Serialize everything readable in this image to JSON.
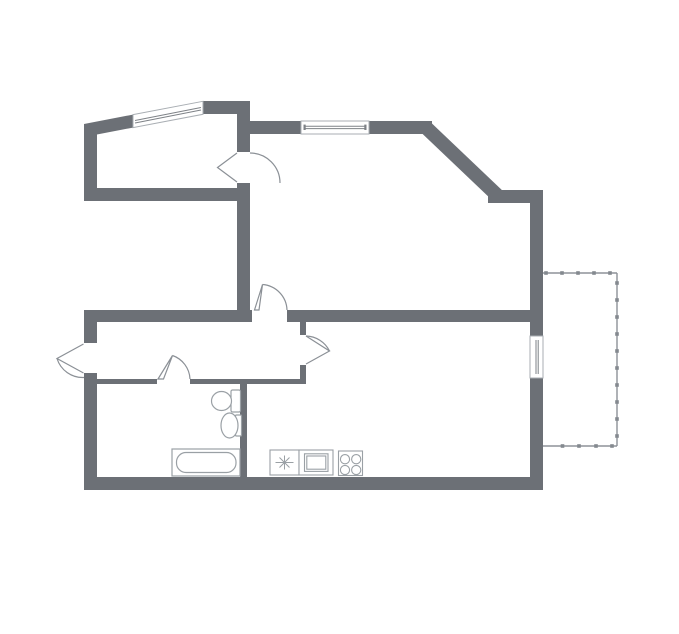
{
  "floorplan": {
    "canvas": {
      "w": 679,
      "h": 634,
      "bg": "#ffffff"
    },
    "colors": {
      "wall": "#6c7076",
      "fixture": "#9aa0a5",
      "railing": "#8d9298",
      "glaze": "#7e8287"
    },
    "groups": [
      {
        "name": "walls",
        "defaults": {
          "fill": "#6c7076",
          "stroke": "none",
          "sw": 0
        },
        "shapes": [
          {
            "name": "wall-room1-left",
            "kind": "rect",
            "x": 84,
            "y": 124,
            "w": 13,
            "h": 77
          },
          {
            "name": "wall-room1-slant",
            "kind": "poly",
            "points": "84,124 133,114.6 133,127.6 84,137"
          },
          {
            "name": "wall-room1-top",
            "kind": "rect",
            "x": 203,
            "y": 101,
            "w": 47,
            "h": 13
          },
          {
            "name": "wall-room1-right-upper",
            "kind": "rect",
            "x": 237,
            "y": 101,
            "w": 13,
            "h": 51
          },
          {
            "name": "wall-room1-right-lower",
            "kind": "rect",
            "x": 237,
            "y": 183,
            "w": 13,
            "h": 139
          },
          {
            "name": "wall-room1-bottom",
            "kind": "rect",
            "x": 84,
            "y": 188,
            "w": 166,
            "h": 13
          },
          {
            "name": "wall-living-top-left",
            "kind": "rect",
            "x": 250,
            "y": 121,
            "w": 51,
            "h": 13
          },
          {
            "name": "wall-living-top-right",
            "kind": "rect",
            "x": 369,
            "y": 121,
            "w": 63,
            "h": 13
          },
          {
            "name": "wall-diagonal",
            "kind": "line",
            "x1": 426,
            "y1": 127.5,
            "x2": 499,
            "y2": 197,
            "stroke": "#6c7076",
            "sw": 14
          },
          {
            "name": "wall-topright-horizontal",
            "kind": "rect",
            "x": 488,
            "y": 190,
            "w": 55,
            "h": 13
          },
          {
            "name": "wall-right-upper",
            "kind": "rect",
            "x": 530,
            "y": 190,
            "w": 13,
            "h": 146
          },
          {
            "name": "wall-right-lower",
            "kind": "rect",
            "x": 530,
            "y": 378,
            "w": 13,
            "h": 112
          },
          {
            "name": "wall-bottom",
            "kind": "rect",
            "x": 84,
            "y": 477,
            "w": 459,
            "h": 13
          },
          {
            "name": "wall-left-lower-above-door",
            "kind": "rect",
            "x": 84,
            "y": 310,
            "w": 13,
            "h": 33
          },
          {
            "name": "wall-left-lower-below-door",
            "kind": "rect",
            "x": 84,
            "y": 373,
            "w": 13,
            "h": 117
          },
          {
            "name": "wall-hall-top-left",
            "kind": "rect",
            "x": 84,
            "y": 310,
            "w": 168,
            "h": 12
          },
          {
            "name": "wall-hall-top-right",
            "kind": "rect",
            "x": 287,
            "y": 310,
            "w": 256,
            "h": 12
          },
          {
            "name": "wall-bath-top-left",
            "kind": "rect",
            "x": 96,
            "y": 379,
            "w": 61,
            "h": 5
          },
          {
            "name": "wall-bath-top-right",
            "kind": "rect",
            "x": 190,
            "y": 379,
            "w": 116,
            "h": 5
          },
          {
            "name": "wall-bath-right",
            "kind": "rect",
            "x": 240,
            "y": 384,
            "w": 7,
            "h": 93
          },
          {
            "name": "wall-kitchen-door-stub-upper",
            "kind": "rect",
            "x": 300,
            "y": 322,
            "w": 6,
            "h": 13
          },
          {
            "name": "wall-kitchen-door-stub-lower",
            "kind": "rect",
            "x": 300,
            "y": 365,
            "w": 6,
            "h": 14
          }
        ]
      },
      {
        "name": "windows",
        "defaults": {
          "stroke": "#a9aeb3",
          "fill": "#ffffff",
          "sw": 1
        },
        "shapes": [
          {
            "name": "window-room1-slanted",
            "kind": "poly",
            "points": "133,114.6 203,101.3 203,114.3 133,127.6"
          },
          {
            "name": "window-room1-glaze-line-1",
            "kind": "line",
            "x1": 135,
            "y1": 120.5,
            "x2": 201,
            "y2": 107.5,
            "stroke": "#7e8287"
          },
          {
            "name": "window-room1-glaze-line-2",
            "kind": "line",
            "x1": 135,
            "y1": 123,
            "x2": 201,
            "y2": 110,
            "stroke": "#7e8287"
          },
          {
            "name": "window-living-top",
            "kind": "rect",
            "x": 301,
            "y": 121,
            "w": 68,
            "h": 13
          },
          {
            "name": "window-living-glaze-line-1",
            "kind": "line",
            "x1": 304,
            "y1": 126.3,
            "x2": 366,
            "y2": 126.3,
            "stroke": "#7e8287"
          },
          {
            "name": "window-living-glaze-line-2",
            "kind": "line",
            "x1": 304,
            "y1": 128.6,
            "x2": 366,
            "y2": 128.6,
            "stroke": "#7e8287"
          },
          {
            "name": "window-living-tick-left",
            "kind": "rect",
            "x": 303.5,
            "y": 124.6,
            "w": 2.2,
            "h": 5.4,
            "fill": "#7e8287",
            "stroke": "none"
          },
          {
            "name": "window-living-tick-right",
            "kind": "rect",
            "x": 364.3,
            "y": 124.6,
            "w": 2.2,
            "h": 5.4,
            "fill": "#7e8287",
            "stroke": "none"
          },
          {
            "name": "window-balcony",
            "kind": "rect",
            "x": 530,
            "y": 336,
            "w": 13,
            "h": 42
          },
          {
            "name": "window-balcony-glaze-line-1",
            "kind": "line",
            "x1": 536,
            "y1": 340,
            "x2": 536,
            "y2": 374,
            "stroke": "#7e8287"
          },
          {
            "name": "window-balcony-glaze-line-2",
            "kind": "line",
            "x1": 538.2,
            "y1": 340,
            "x2": 538.2,
            "y2": 374,
            "stroke": "#7e8287"
          }
        ]
      },
      {
        "name": "doors",
        "defaults": {
          "stroke": "#8b9096",
          "fill": "none",
          "sw": 1.2
        },
        "shapes": [
          {
            "name": "door-room1-leaf",
            "kind": "path",
            "d": "M 237 153 L 217.5 167.5 L 237 182",
            "fill": "#ffffff"
          },
          {
            "name": "door-room1-swing-arc",
            "kind": "path",
            "d": "M 250 153 A 30 30 0 0 1 280 183"
          },
          {
            "name": "door-living-hall-leaf",
            "kind": "path",
            "d": "M 254.5 310 L 262.5 284.5 L 259 310 Z",
            "fill": "#ffffff"
          },
          {
            "name": "door-living-hall-swing-arc",
            "kind": "path",
            "d": "M 262.5 284.5 A 26.5 26.5 0 0 1 287 310"
          },
          {
            "name": "door-entrance-leaf",
            "kind": "path",
            "d": "M 83.5 344 L 57 358.5 L 83.5 373",
            "fill": "#ffffff"
          },
          {
            "name": "door-entrance-swing-arc",
            "kind": "path",
            "d": "M 57 358.5 A 27 27 0 0 0 84 377.5"
          },
          {
            "name": "door-bathroom-leaf",
            "kind": "path",
            "d": "M 158 379 L 172.5 355.5 L 163.5 379 Z",
            "fill": "#ffffff"
          },
          {
            "name": "door-bathroom-swing-arc",
            "kind": "path",
            "d": "M 172.5 355.5 A 26 26 0 0 1 190 379"
          },
          {
            "name": "door-kitchen-leaf",
            "kind": "path",
            "d": "M 306 336 L 329.5 351 L 306 364",
            "fill": "#ffffff"
          },
          {
            "name": "door-kitchen-swing-arc",
            "kind": "path",
            "d": "M 306 336 A 27 27 0 0 1 329.5 351"
          }
        ]
      },
      {
        "name": "balcony-railing",
        "defaults": {
          "stroke": "#8d9298",
          "fill": "none",
          "sw": 1.4
        },
        "shapes": [
          {
            "name": "balcony-rail-top",
            "kind": "line",
            "x1": 543,
            "y1": 273,
            "x2": 617,
            "y2": 273
          },
          {
            "name": "balcony-rail-right",
            "kind": "line",
            "x1": 617,
            "y1": 273,
            "x2": 617,
            "y2": 446
          },
          {
            "name": "balcony-rail-bottom",
            "kind": "line",
            "x1": 543,
            "y1": 446,
            "x2": 617,
            "y2": 446
          },
          {
            "name": "balcony-post",
            "kind": "rect",
            "x": 544.2,
            "y": 271.2,
            "w": 3.6,
            "h": 3.6,
            "fill": "#84898f",
            "stroke": "none"
          },
          {
            "name": "balcony-post",
            "kind": "rect",
            "x": 560.2,
            "y": 271.2,
            "w": 3.6,
            "h": 3.6,
            "fill": "#84898f",
            "stroke": "none"
          },
          {
            "name": "balcony-post",
            "kind": "rect",
            "x": 576.2,
            "y": 271.2,
            "w": 3.6,
            "h": 3.6,
            "fill": "#84898f",
            "stroke": "none"
          },
          {
            "name": "balcony-post",
            "kind": "rect",
            "x": 592.2,
            "y": 271.2,
            "w": 3.6,
            "h": 3.6,
            "fill": "#84898f",
            "stroke": "none"
          },
          {
            "name": "balcony-post",
            "kind": "rect",
            "x": 608.2,
            "y": 271.2,
            "w": 3.6,
            "h": 3.6,
            "fill": "#84898f",
            "stroke": "none"
          },
          {
            "name": "balcony-post",
            "kind": "rect",
            "x": 615.2,
            "y": 281.2,
            "w": 3.6,
            "h": 3.6,
            "fill": "#84898f",
            "stroke": "none"
          },
          {
            "name": "balcony-post",
            "kind": "rect",
            "x": 615.2,
            "y": 298.2,
            "w": 3.6,
            "h": 3.6,
            "fill": "#84898f",
            "stroke": "none"
          },
          {
            "name": "balcony-post",
            "kind": "rect",
            "x": 615.2,
            "y": 315.2,
            "w": 3.6,
            "h": 3.6,
            "fill": "#84898f",
            "stroke": "none"
          },
          {
            "name": "balcony-post",
            "kind": "rect",
            "x": 615.2,
            "y": 332.2,
            "w": 3.6,
            "h": 3.6,
            "fill": "#84898f",
            "stroke": "none"
          },
          {
            "name": "balcony-post",
            "kind": "rect",
            "x": 615.2,
            "y": 349.2,
            "w": 3.6,
            "h": 3.6,
            "fill": "#84898f",
            "stroke": "none"
          },
          {
            "name": "balcony-post",
            "kind": "rect",
            "x": 615.2,
            "y": 366.2,
            "w": 3.6,
            "h": 3.6,
            "fill": "#84898f",
            "stroke": "none"
          },
          {
            "name": "balcony-post",
            "kind": "rect",
            "x": 615.2,
            "y": 383.2,
            "w": 3.6,
            "h": 3.6,
            "fill": "#84898f",
            "stroke": "none"
          },
          {
            "name": "balcony-post",
            "kind": "rect",
            "x": 615.2,
            "y": 400.2,
            "w": 3.6,
            "h": 3.6,
            "fill": "#84898f",
            "stroke": "none"
          },
          {
            "name": "balcony-post",
            "kind": "rect",
            "x": 615.2,
            "y": 417.2,
            "w": 3.6,
            "h": 3.6,
            "fill": "#84898f",
            "stroke": "none"
          },
          {
            "name": "balcony-post",
            "kind": "rect",
            "x": 615.2,
            "y": 434.2,
            "w": 3.6,
            "h": 3.6,
            "fill": "#84898f",
            "stroke": "none"
          },
          {
            "name": "balcony-post",
            "kind": "rect",
            "x": 560.7,
            "y": 444.2,
            "w": 3.6,
            "h": 3.6,
            "fill": "#84898f",
            "stroke": "none"
          },
          {
            "name": "balcony-post",
            "kind": "rect",
            "x": 577.2,
            "y": 444.2,
            "w": 3.6,
            "h": 3.6,
            "fill": "#84898f",
            "stroke": "none"
          },
          {
            "name": "balcony-post",
            "kind": "rect",
            "x": 594.2,
            "y": 444.2,
            "w": 3.6,
            "h": 3.6,
            "fill": "#84898f",
            "stroke": "none"
          },
          {
            "name": "balcony-post",
            "kind": "rect",
            "x": 610.2,
            "y": 444.2,
            "w": 3.6,
            "h": 3.6,
            "fill": "#84898f",
            "stroke": "none"
          }
        ]
      },
      {
        "name": "bathroom-fixtures",
        "defaults": {
          "stroke": "#9aa0a5",
          "fill": "#ffffff",
          "sw": 1.2
        },
        "shapes": [
          {
            "name": "toilet-tank",
            "kind": "rect",
            "x": 231,
            "y": 390,
            "w": 9.5,
            "h": 22,
            "rx": 1.5
          },
          {
            "name": "toilet-bowl",
            "kind": "ellipse",
            "cx": 221.5,
            "cy": 401,
            "rx": 10,
            "ry": 9.5
          },
          {
            "name": "washbasin-base",
            "kind": "rect",
            "x": 235.5,
            "y": 415,
            "w": 6,
            "h": 21,
            "rx": 1
          },
          {
            "name": "washbasin-bowl",
            "kind": "ellipse",
            "cx": 229.5,
            "cy": 425.5,
            "rx": 8.5,
            "ry": 12.5
          },
          {
            "name": "bathtub-outer",
            "kind": "rect",
            "x": 172,
            "y": 449,
            "w": 68,
            "h": 27
          },
          {
            "name": "bathtub-inner",
            "kind": "rect",
            "x": 176.5,
            "y": 452.5,
            "w": 59.5,
            "h": 20,
            "rx": 9.5
          }
        ]
      },
      {
        "name": "kitchen-fixtures",
        "defaults": {
          "stroke": "#9aa0a5",
          "fill": "#ffffff",
          "sw": 1.1
        },
        "shapes": [
          {
            "name": "kitchen-sink-counter",
            "kind": "rect",
            "x": 270,
            "y": 450,
            "w": 29,
            "h": 25
          },
          {
            "name": "kitchen-faucet-star",
            "kind": "path",
            "d": "M 275.5 462.5 L 293.5 462.5 M 284.5 455.5 L 284.5 469.5 M 279.5 457.5 L 289.5 467.5 M 289.5 457.5 L 279.5 467.5",
            "fill": "none",
            "sw": 1
          },
          {
            "name": "oven-outer",
            "kind": "rect",
            "x": 299,
            "y": 450,
            "w": 34,
            "h": 25
          },
          {
            "name": "oven-mid",
            "kind": "rect",
            "x": 304.5,
            "y": 453.8,
            "w": 23.5,
            "h": 17.6
          },
          {
            "name": "oven-inner",
            "kind": "rect",
            "x": 306.8,
            "y": 456,
            "w": 19,
            "h": 13.2
          },
          {
            "name": "stove-box",
            "kind": "rect",
            "x": 338.5,
            "y": 451,
            "w": 24,
            "h": 24.5
          },
          {
            "name": "stove-burner",
            "kind": "circle",
            "cx": 345,
            "cy": 459.2,
            "r": 4.6
          },
          {
            "name": "stove-burner",
            "kind": "circle",
            "cx": 356.2,
            "cy": 459.2,
            "r": 4.6
          },
          {
            "name": "stove-burner",
            "kind": "circle",
            "cx": 345,
            "cy": 470,
            "r": 4.6
          },
          {
            "name": "stove-burner",
            "kind": "circle",
            "cx": 356.2,
            "cy": 470,
            "r": 4.6
          }
        ]
      }
    ]
  }
}
